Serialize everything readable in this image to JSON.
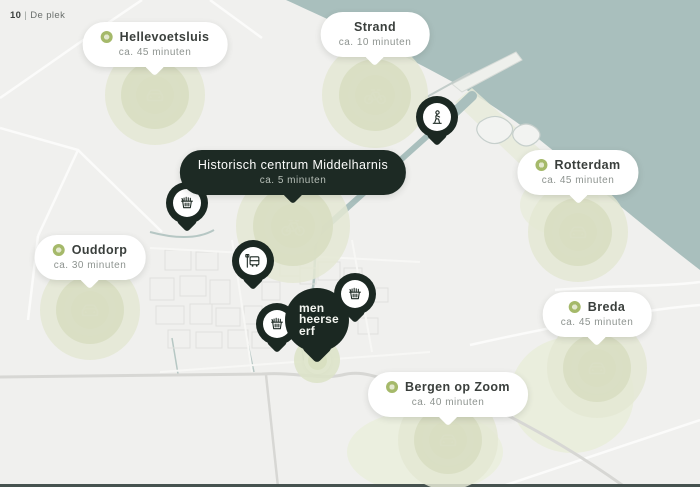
{
  "page": {
    "number": "10",
    "separator": "|",
    "section": "De plek"
  },
  "colors": {
    "accent_green": "#a5b96a",
    "halo_green": "#e4e8d4",
    "pin_dark": "#1b2822",
    "water": "#a9bfbd",
    "land": "#f0f0ee"
  },
  "destinations": [
    {
      "name": "Hellevoetsluis",
      "time": "ca. 45 minuten",
      "mode": "car"
    },
    {
      "name": "Strand",
      "time": "ca. 10 minuten",
      "mode": "bicycle"
    },
    {
      "name": "Historisch centrum Middelharnis",
      "time": "ca. 5 minuten",
      "mode": "bicycle"
    },
    {
      "name": "Rotterdam",
      "time": "ca. 45 minuten",
      "mode": "car"
    },
    {
      "name": "Ouddorp",
      "time": "ca. 30 minuten",
      "mode": "car"
    },
    {
      "name": "Breda",
      "time": "ca. 45 minuten",
      "mode": "car"
    },
    {
      "name": "Bergen op Zoom",
      "time": "ca. 40 minuten",
      "mode": "car"
    }
  ],
  "home": {
    "lines": [
      "men",
      "heerse",
      "erf"
    ]
  },
  "pois": [
    {
      "icon": "grocery-basket"
    },
    {
      "icon": "grocery-basket"
    },
    {
      "icon": "grocery-basket"
    },
    {
      "icon": "bus-stop"
    },
    {
      "icon": "person-statue"
    }
  ]
}
